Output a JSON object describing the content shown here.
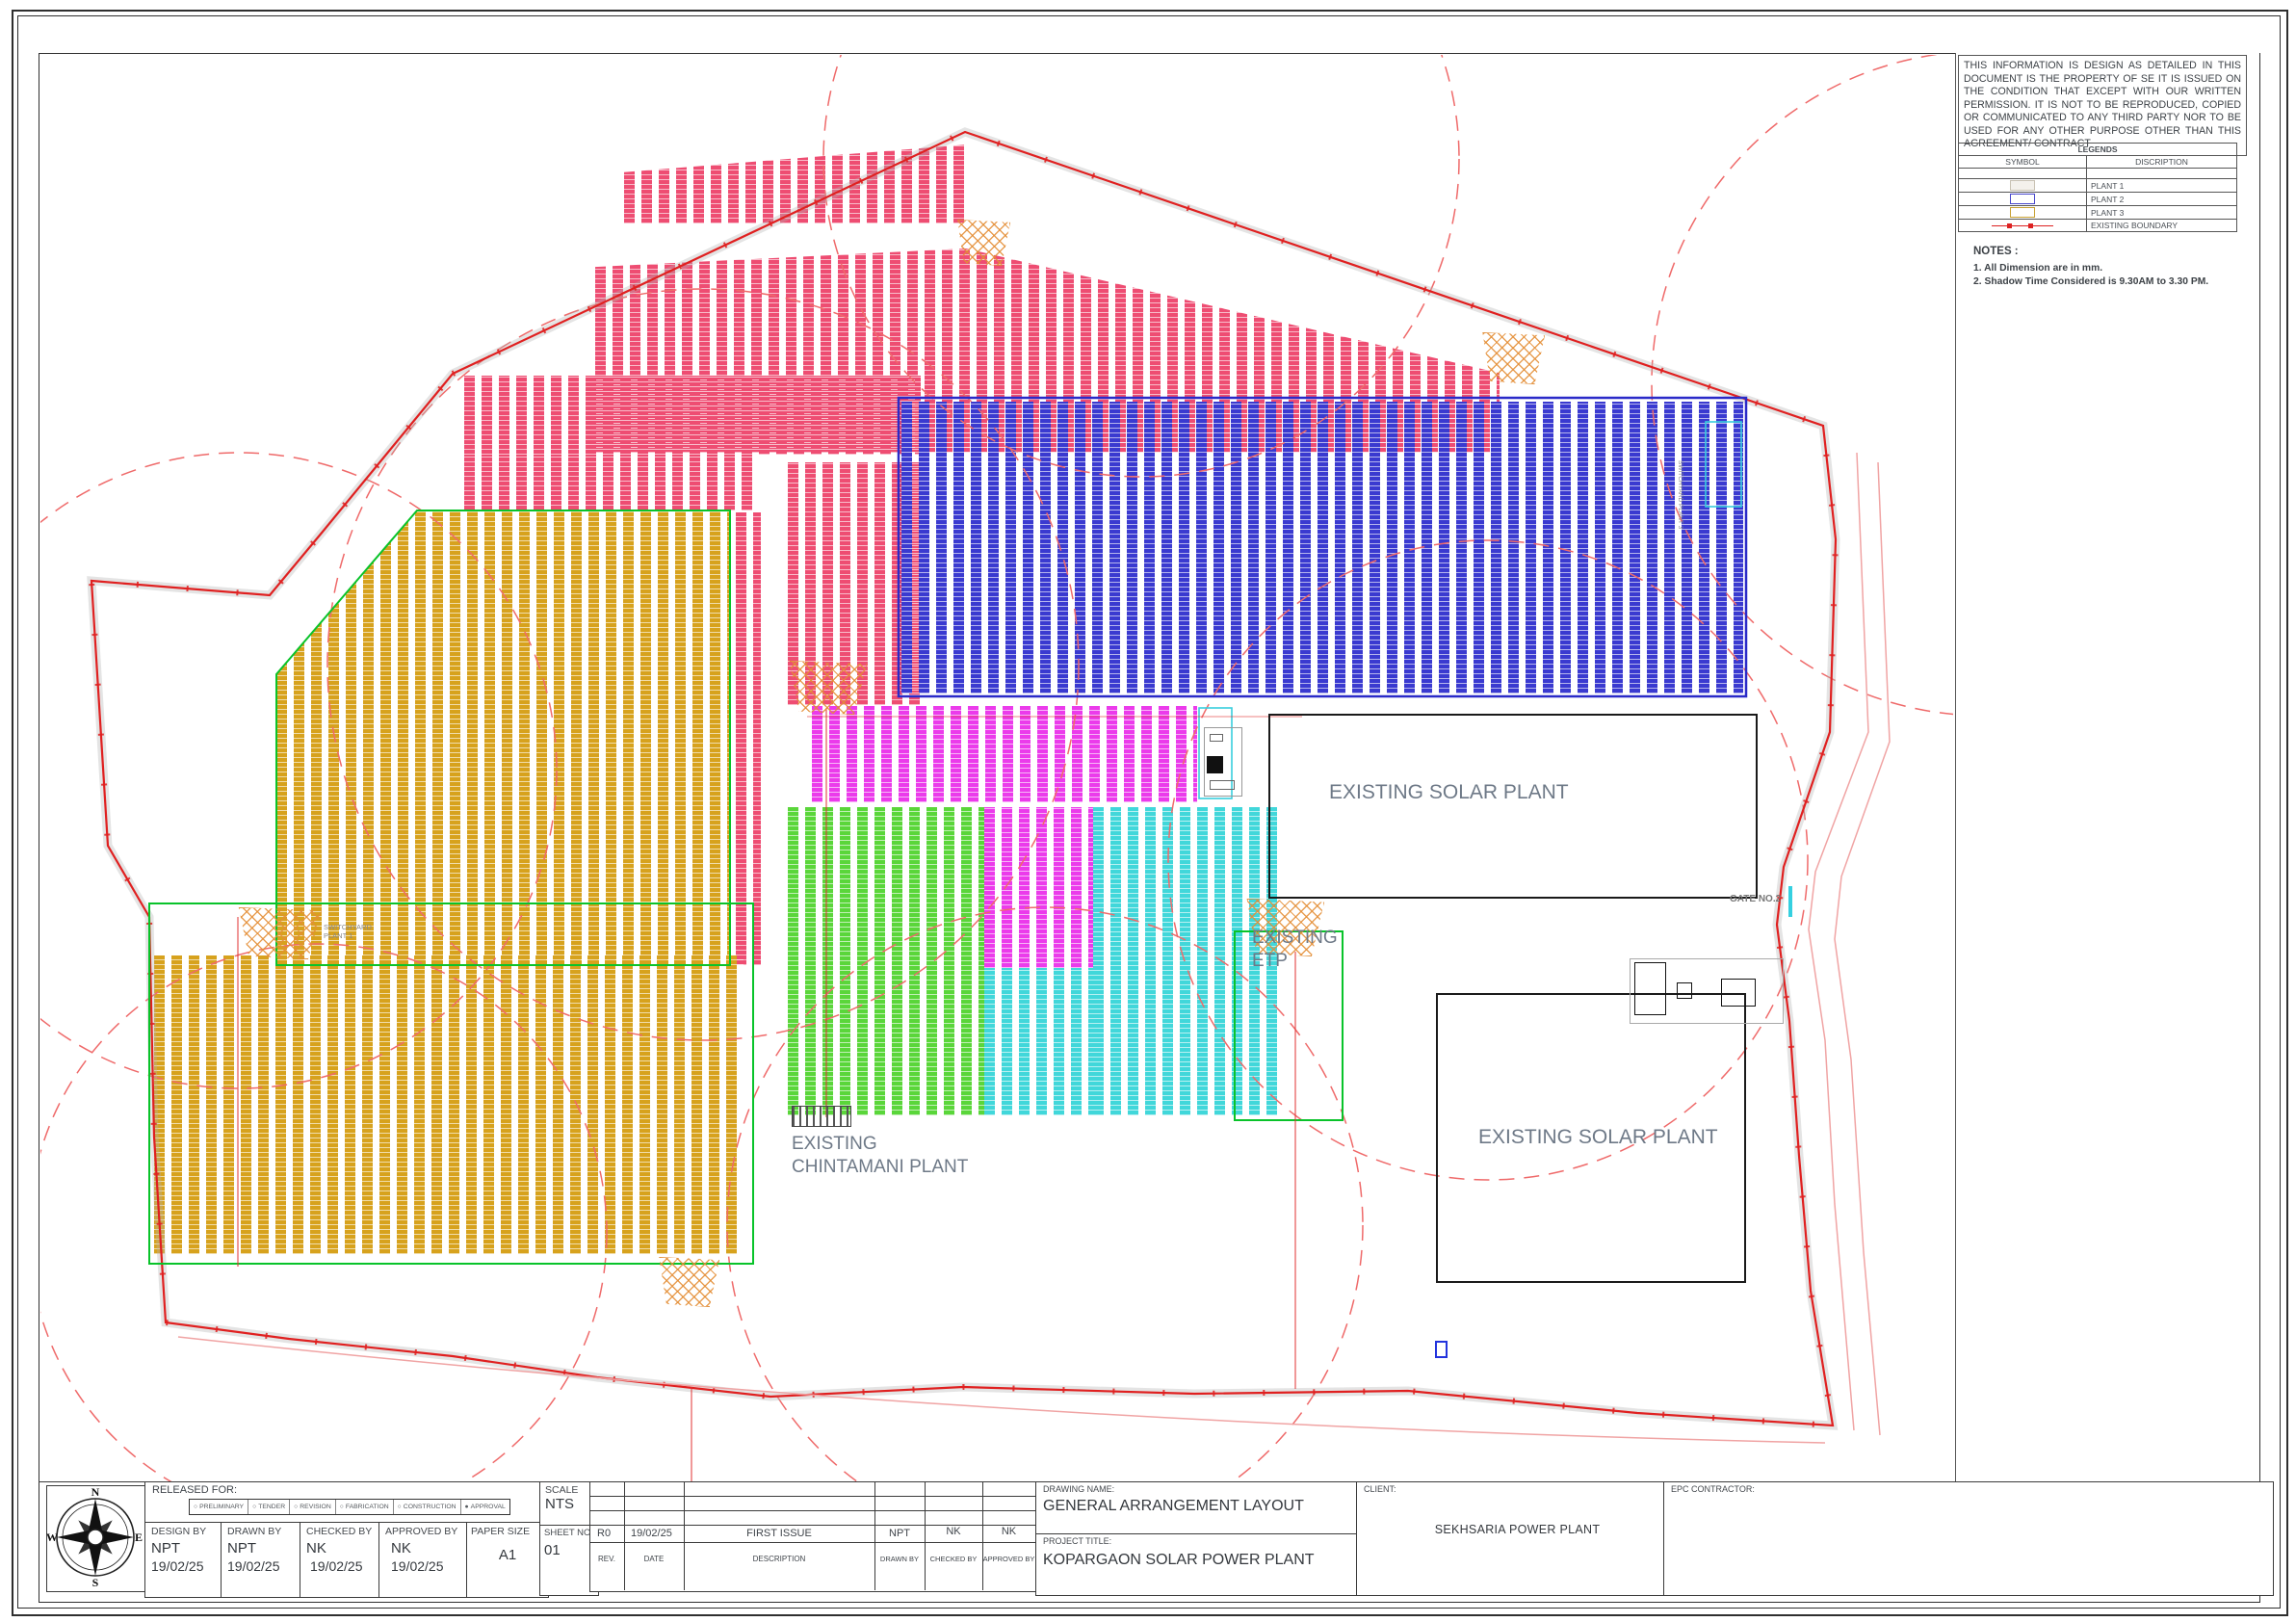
{
  "disclaimer": "THIS INFORMATION IS DESIGN AS DETAILED IN THIS DOCUMENT IS THE PROPERTY OF SE IT IS ISSUED ON THE CONDITION THAT EXCEPT WITH OUR WRITTEN PERMISSION. IT IS NOT TO BE REPRODUCED, COPIED OR COMMUNICATED TO ANY THIRD PARTY NOR TO BE USED FOR ANY OTHER PURPOSE OTHER THAN THIS AGREEMENT/ CONTRACT",
  "legends": {
    "title": "LEGENDS",
    "col_symbol": "SYMBOL",
    "col_description": "DISCRIPTION",
    "rows": [
      {
        "label": "PLANT 1",
        "fill": "#f4f1ec",
        "border": "#c9c2b4"
      },
      {
        "label": "PLANT 2",
        "fill": "#ffffff",
        "border": "#4747cc"
      },
      {
        "label": "PLANT 3",
        "fill": "#ffffff",
        "border": "#c8a235"
      },
      {
        "label": "EXISTING BOUNDARY",
        "fill": "none",
        "border": "#dd2222"
      }
    ]
  },
  "notes": {
    "title": "NOTES :",
    "items": [
      "1.      All Dimension are in mm.",
      "2.      Shadow Time Considered is 9.30AM to 3.30 PM."
    ]
  },
  "drawing": {
    "labels": {
      "solar1": "EXISTING SOLAR PLANT",
      "solar2": "EXISTING SOLAR PLANT",
      "etp_line1": "EXISTING",
      "etp_line2": "ETP",
      "chintamani_line1": "EXISTING",
      "chintamani_line2": "CHINTAMANI PLANT",
      "gate": "GATE NO.2",
      "switchyard1_line1": "SWITCHYARD",
      "switchyard1_line2": "PLANT 1",
      "switchyard3": "SWITCHYARD PLANT 3"
    },
    "colors": {
      "boundary": "#e02020",
      "plant1_modules": "#ee4d72",
      "plant2_modules": "#3a3ad0",
      "plant3_modules": "#d7a21d",
      "magenta_modules": "#eb3beb",
      "green_modules": "#5ad63a",
      "cyan_modules": "#41d7da"
    }
  },
  "compass": {
    "n": "N",
    "e": "E",
    "s": "S",
    "w": "W"
  },
  "titleblock": {
    "released_label": "RELEASED FOR:",
    "options": [
      {
        "sym": "○",
        "label": "PRELIMINARY"
      },
      {
        "sym": "○",
        "label": "TENDER"
      },
      {
        "sym": "○",
        "label": "REVISION"
      },
      {
        "sym": "○",
        "label": "FABRICATION"
      },
      {
        "sym": "○",
        "label": "CONSTRUCTION"
      },
      {
        "sym": "●",
        "label": "APPROVAL"
      }
    ],
    "signers": [
      {
        "label": "DESIGN BY",
        "name": "NPT",
        "date": "19/02/25"
      },
      {
        "label": "DRAWN BY",
        "name": "NPT",
        "date": "19/02/25"
      },
      {
        "label": "CHECKED BY",
        "name": "NK",
        "date": "19/02/25"
      },
      {
        "label": "APPROVED  BY",
        "name": "NK",
        "date": "19/02/25"
      }
    ],
    "paper_label": "PAPER SIZE",
    "paper_value": "A1",
    "scale_label": "SCALE",
    "scale_value": "NTS",
    "sheet_label": "SHEET NO.",
    "sheet_value": "01",
    "revision": {
      "row": {
        "rev": "R0",
        "date": "19/02/25",
        "desc": "FIRST ISSUE",
        "drawn": "NPT",
        "checked": "NK",
        "approved": "NK"
      },
      "headers": [
        "REV.",
        "DATE",
        "DESCRIPTION",
        "DRAWN BY",
        "CHECKED BY",
        "APPROVED BY"
      ]
    },
    "drawing_name_label": "DRAWING NAME:",
    "drawing_name": "GENERAL ARRANGEMENT LAYOUT",
    "project_title_label": "PROJECT TITLE:",
    "project_title": "KOPARGAON SOLAR POWER PLANT",
    "client_label": "CLIENT:",
    "client_value": "SEKHSARIA POWER PLANT",
    "epc_label": "EPC CONTRACTOR:"
  }
}
